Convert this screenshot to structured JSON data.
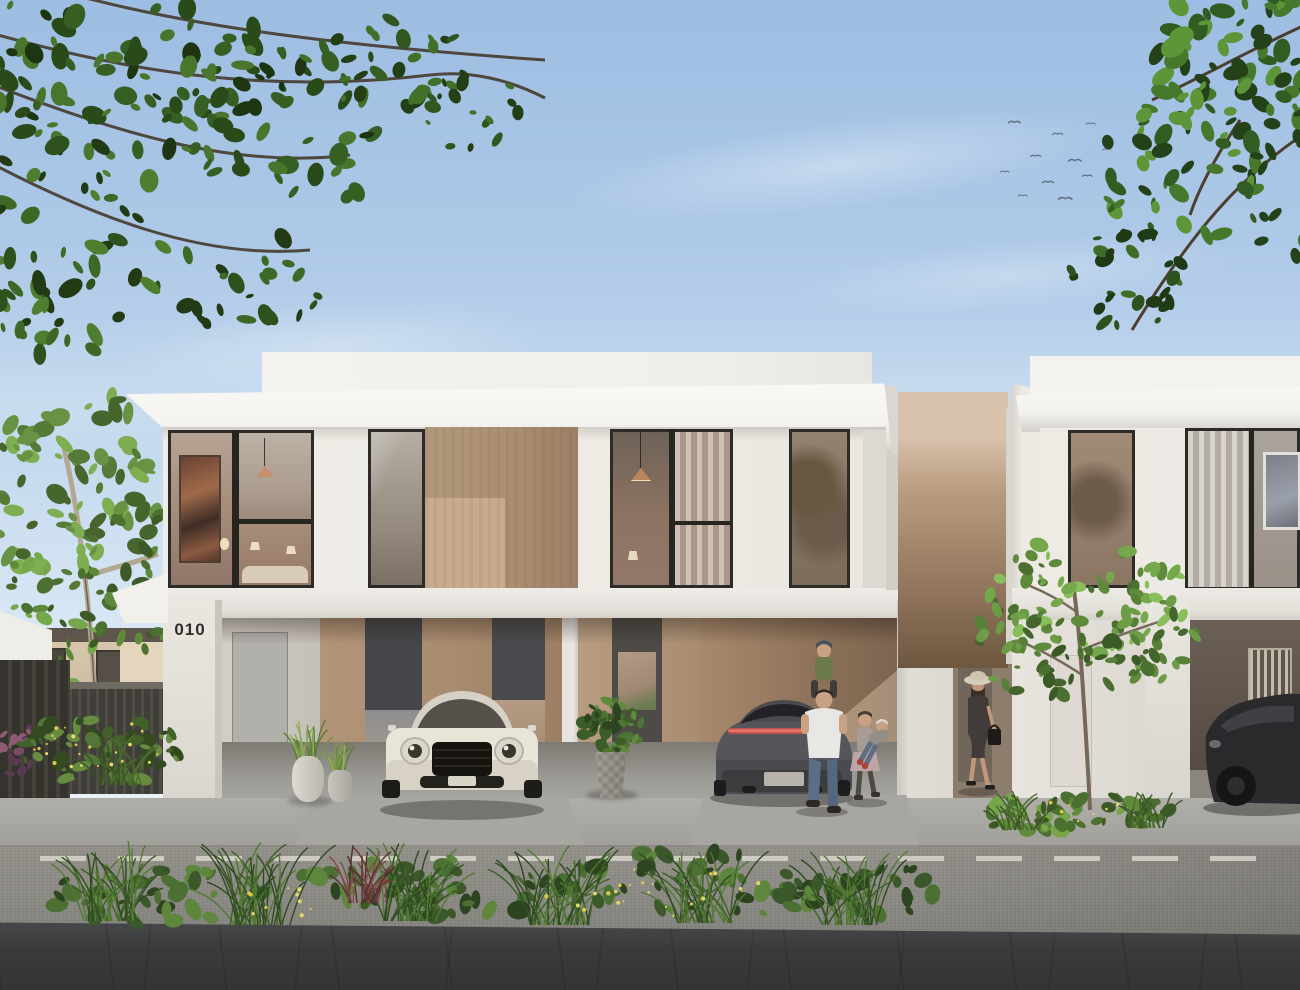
{
  "scene": {
    "type": "3D architectural rendering",
    "setting": "Street view of modern two-storey white townhouses with carports, daytime",
    "house_numbers": {
      "left": "010",
      "right": "011"
    },
    "vehicles": [
      "white luxury coupe parked in carport of unit 010",
      "dark grey fastback sedan parked in carport of unit 011",
      "black car in far-right carport"
    ],
    "people": [
      "man in white t-shirt carrying child on shoulders",
      "girl swinging a toddler",
      "woman in sun hat with handbag walking"
    ],
    "birds_count": 11,
    "colors": {
      "sky_top": "#9dbde2",
      "sky_bottom": "#edf3f8",
      "facade_white": "#efece6",
      "roof_white": "#f8f7f4",
      "wood_panel": "#b1977c",
      "carport_interior": "#a8896d",
      "window_frame": "#2c2b27",
      "house_number_text": "#2f2e2a",
      "foliage_dark": "#2a4a1a",
      "foliage_light": "#74a84b",
      "road": "#8b8984",
      "lane_line": "#d9d5cd",
      "foreground_paving": "#3a3b3d",
      "car_white": "#ece7dd",
      "car_dark": "#47474b",
      "taillight_red": "#c2524a"
    }
  }
}
